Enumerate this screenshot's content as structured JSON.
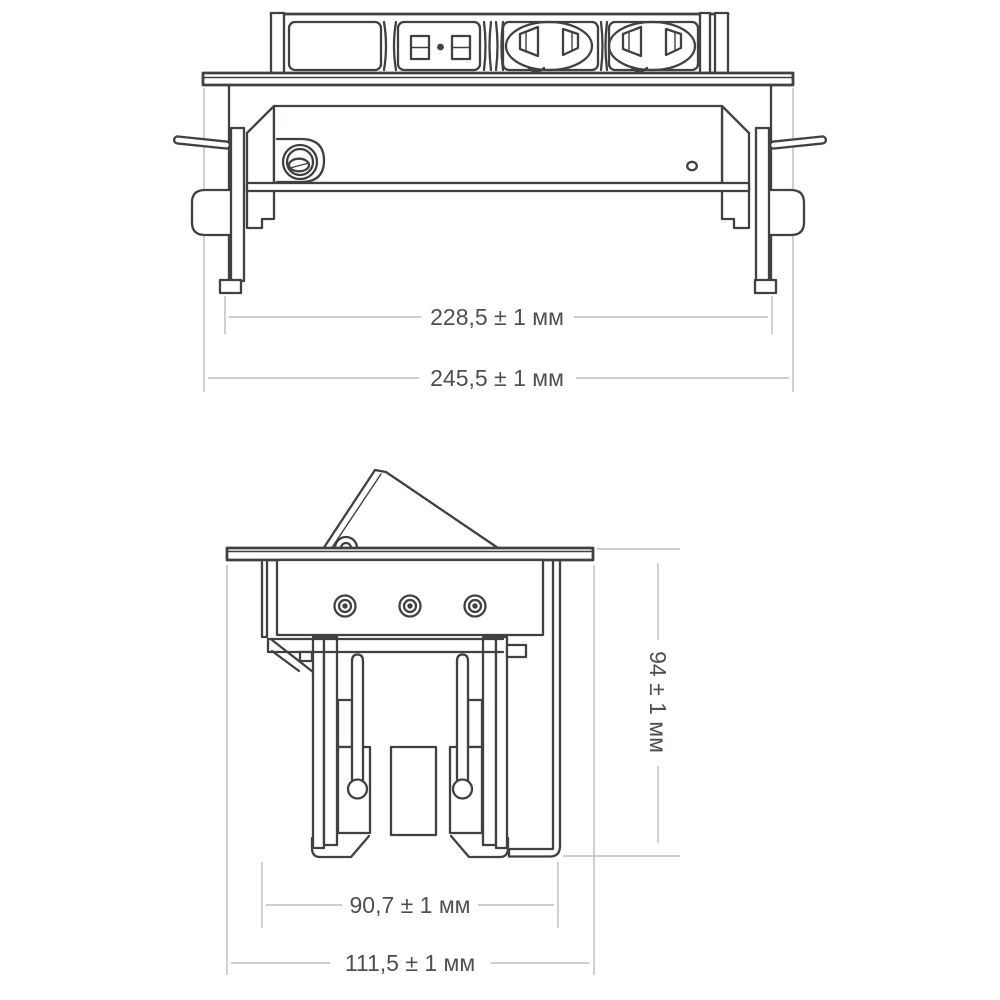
{
  "drawing": {
    "kind": "technical-dimension-drawing",
    "views": {
      "front": {
        "dimensions": {
          "mount_width": "228,5 ± 1 мм",
          "plate_width": "245,5 ± 1 мм"
        }
      },
      "side": {
        "dimensions": {
          "height": "94 ± 1 мм",
          "mount_width": "90,7 ± 1 мм",
          "plate_width": "111,5 ± 1 мм"
        }
      }
    }
  },
  "colors": {
    "ink": "#3e4245",
    "dimension_lines": "#c6c8c9",
    "dimension_text": "#4c5052",
    "background": "#ffffff"
  }
}
